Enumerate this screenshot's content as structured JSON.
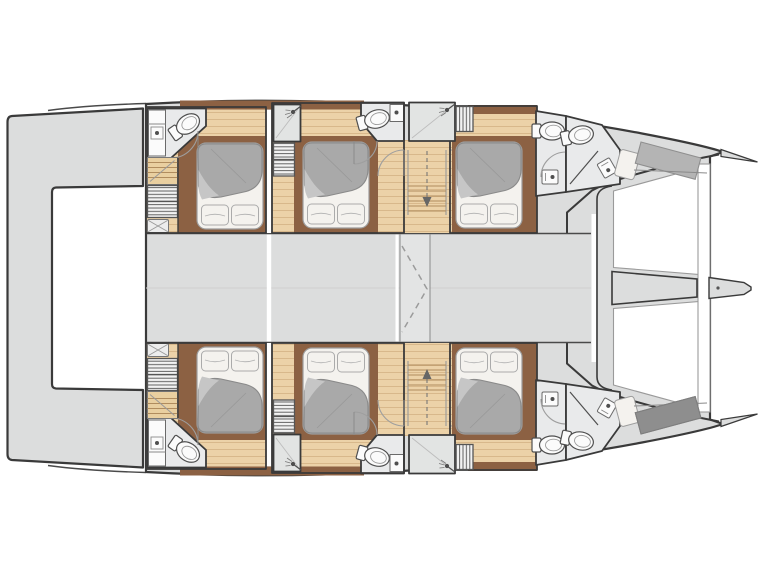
{
  "plan": {
    "description": "Catamaran yacht lower-deck floor plan, top-down view, bow to the right",
    "vessel_type": "catamaran",
    "symmetry": "port and starboard hulls mirrored about the centerline",
    "hull_count": 2,
    "double_cabins": 6,
    "forepeak_berths": 2,
    "per_hull": {
      "cabins": [
        {
          "name": "aft cabin",
          "features": [
            "double-bed",
            "ensuite-bathroom",
            "toilet",
            "sink-counter",
            "staircase",
            "wardrobe-shelves",
            "ottoman"
          ]
        },
        {
          "name": "mid cabin",
          "features": [
            "double-bed",
            "shower-stall",
            "toilet",
            "sink-counter",
            "wardrobe-shelves"
          ]
        },
        {
          "name": "forward cabin",
          "features": [
            "double-bed",
            "shower-stall",
            "hanging-locker"
          ]
        }
      ],
      "corridor": {
        "features": [
          "companionway-stairs",
          "down-arrow",
          "doors"
        ]
      },
      "bow_section": {
        "features": [
          "wc-compartment",
          "shower-compartment",
          "forepeak-berth"
        ]
      }
    },
    "foredeck": {
      "features": [
        "trampoline-panels",
        "forward-crossbeam",
        "longitudinal-beam",
        "bowsprit-tip"
      ]
    },
    "aft_deck": {
      "features": [
        "aft-platform-between-hulls"
      ]
    },
    "bridgedeck": {
      "features": [
        "central-walkway-strip",
        "dashed-structure-outline"
      ]
    }
  },
  "colors": {
    "background": "#ffffff",
    "outline": "#3a3a3a",
    "deck": "#dcdddd",
    "deck_strip": "#e3e4e4",
    "seam": "#d0d0d0",
    "white_gap": "#ffffff",
    "wood": "#ecd2a8",
    "wood_line": "#d8b88b",
    "stair_wood": "#e9cfa0",
    "tread": "#b08c5e",
    "brown": "#8c6143",
    "bath": "#e9eaeb",
    "shower": "#e2e4e3",
    "fixture_white": "#fbfbfb",
    "fixture_line": "#4f4f4f",
    "louver": "#5f5f5f",
    "louver_bg": "#f2f2f2",
    "duvet": "#a9a9a9",
    "duvet_edge": "#8a8a8a",
    "fold": "#c6c6c6",
    "linen": "#f4f2ee",
    "linen_line": "#b5b5b5",
    "berth": "#b4b4b4",
    "berth_dark": "#8e8e8e",
    "arc": "#9e9e9e",
    "dash": "#9b9b9b",
    "frame_line": "#9a9a9a"
  }
}
